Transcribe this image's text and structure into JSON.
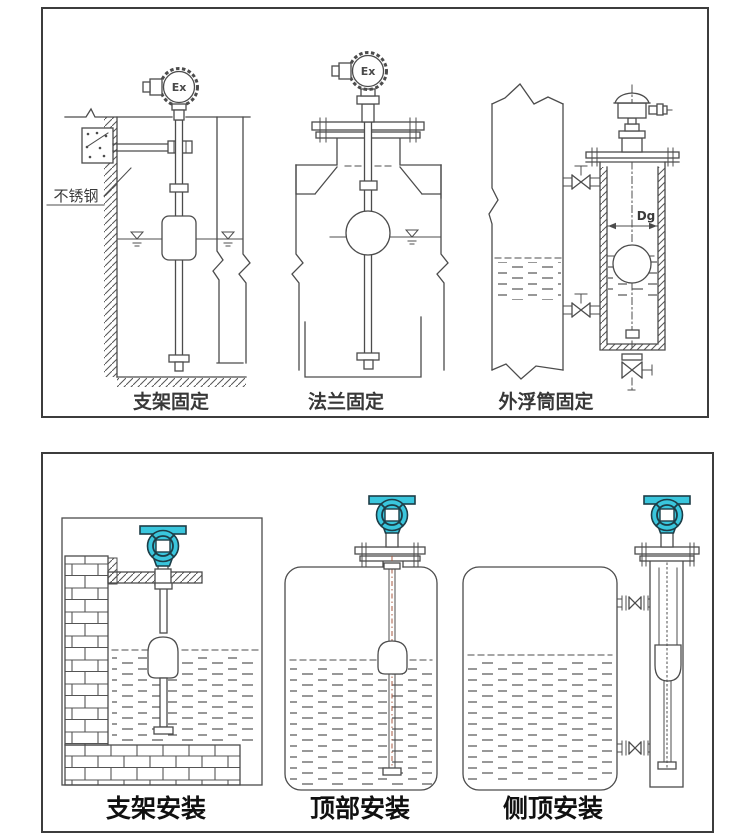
{
  "top_panel": {
    "drawings": [
      {
        "caption": "支架固定"
      },
      {
        "caption": "法兰固定"
      },
      {
        "caption": "外浮筒固定"
      }
    ],
    "stainless_steel_note": "不锈钢",
    "explosion_proof_marking": "Ex",
    "diameter_label": "Dg"
  },
  "bottom_panel": {
    "drawings": [
      {
        "caption": "支架安装"
      },
      {
        "caption": "顶部安装"
      },
      {
        "caption": "侧顶安装"
      }
    ]
  },
  "colors": {
    "transmitter_teal": "#3ac6dd",
    "line_gray": "#4c4c4c",
    "rod_centerline_red": "#a85a40",
    "label_black": "#101010"
  }
}
